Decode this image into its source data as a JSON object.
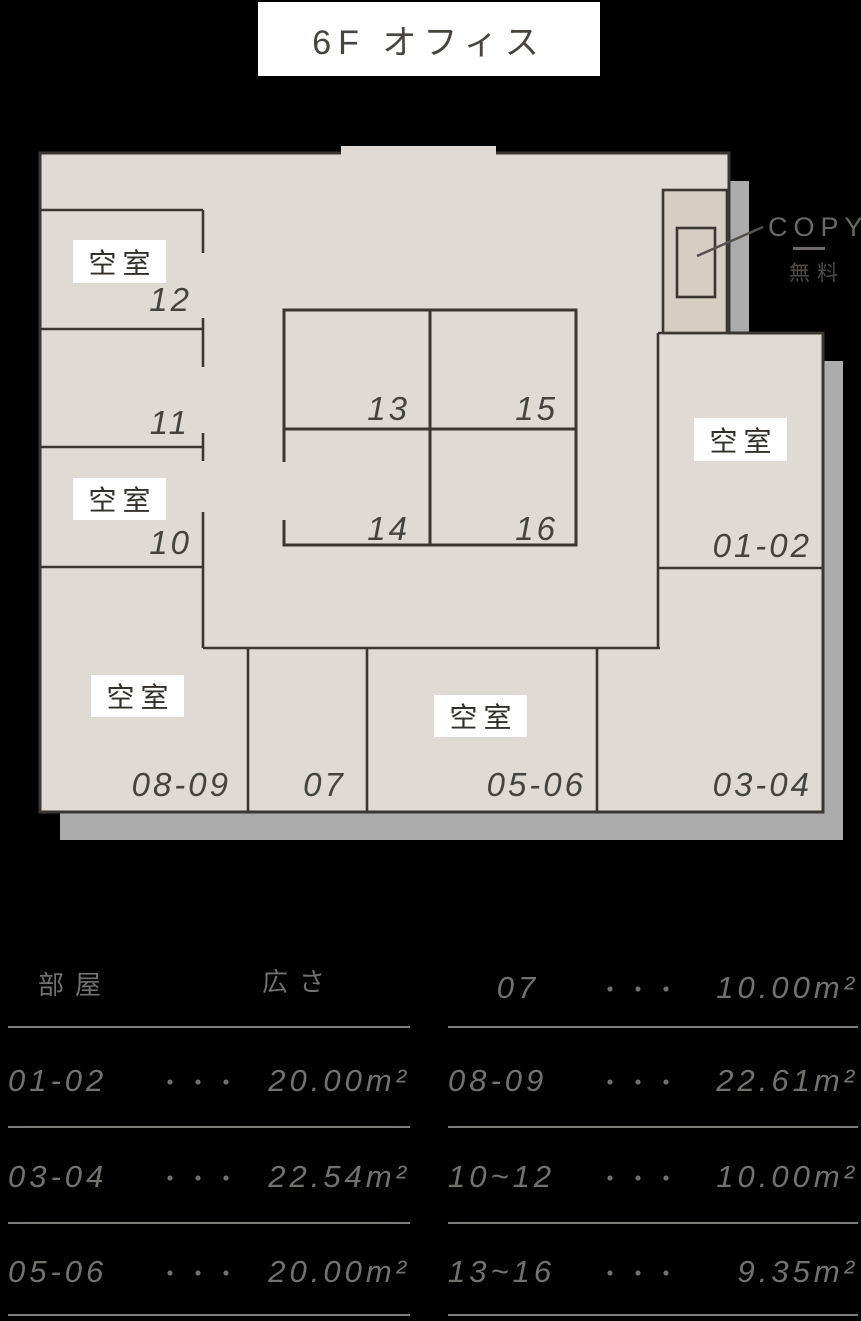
{
  "title": "6F オフィス",
  "plan": {
    "vacant_label": "空室",
    "rooms": {
      "r12": {
        "number": "12",
        "vacant": "空室"
      },
      "r11": {
        "number": "11"
      },
      "r10": {
        "number": "10",
        "vacant": "空室"
      },
      "r13": {
        "number": "13"
      },
      "r14": {
        "number": "14"
      },
      "r15": {
        "number": "15"
      },
      "r16": {
        "number": "16"
      },
      "r0102": {
        "number": "01-02",
        "vacant": "空室"
      },
      "r0304": {
        "number": "03-04"
      },
      "r0506": {
        "number": "05-06",
        "vacant": "空室"
      },
      "r07": {
        "number": "07"
      },
      "r0809": {
        "number": "08-09",
        "vacant": "空室"
      }
    },
    "copy_station": {
      "label": "COPY",
      "note": "無料"
    }
  },
  "legend": {
    "header_room": "部屋",
    "header_size": "広さ",
    "dots": "・・・",
    "left_rows": [
      {
        "room": "01-02",
        "size": "20.00m²"
      },
      {
        "room": "03-04",
        "size": "22.54m²"
      },
      {
        "room": "05-06",
        "size": "20.00m²"
      }
    ],
    "right_rows": [
      {
        "room": "07",
        "size": "10.00m²"
      },
      {
        "room": "08-09",
        "size": "22.61m²"
      },
      {
        "room": "10~12",
        "size": "10.00m²"
      },
      {
        "room": "13~16",
        "size": "9.35m²"
      }
    ]
  },
  "colors": {
    "background": "#000000",
    "floor": "#dfdbd4",
    "copy_room": "#d5cec3",
    "wall": "#3a3733",
    "shadow": "#acacac",
    "label_bg": "#ffffff",
    "legend_text": "#73716e"
  }
}
